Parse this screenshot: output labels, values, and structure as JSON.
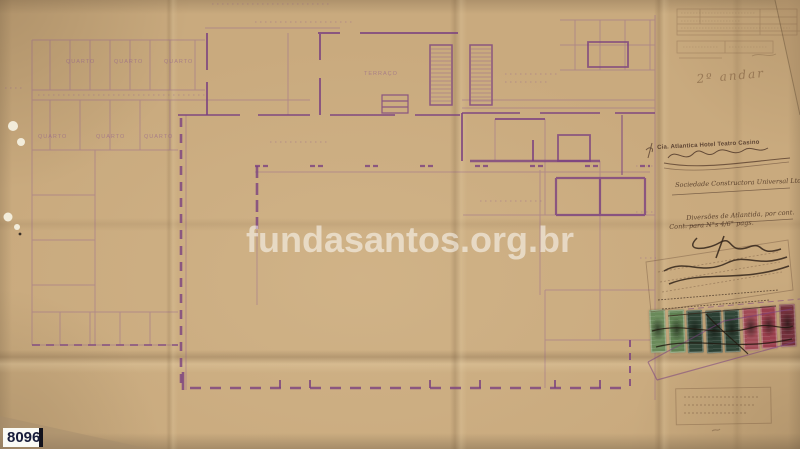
{
  "document": {
    "watermark": "fundasantos.org.br",
    "archive_number": "8096"
  },
  "margin": {
    "floor_note": "2º andar",
    "company_stamp_line": "Cia. Atlantica Hotel Teatro Casino",
    "handwritten_note_1": "Sociedade Constructora Universal Ltda",
    "handwritten_note_2": "Diversões de Atlantida, por cont.",
    "handwritten_note_3": "Cont. para N°s 4/6° pags."
  },
  "plan": {
    "labels": [
      {
        "text": "QUARTO"
      },
      {
        "text": "QUARTO"
      },
      {
        "text": "QUARTO"
      },
      {
        "text": "QUARTO"
      },
      {
        "text": "QUARTO"
      },
      {
        "text": "QUARTO"
      },
      {
        "text": "TERRAÇO"
      }
    ]
  },
  "stamps": {
    "colors": [
      "#6a8a5a",
      "#5f8152",
      "#2f4436",
      "#2b3f33",
      "#2f4436",
      "#a04a55",
      "#9a3f4d",
      "#74313c"
    ]
  },
  "colors": {
    "paper": "#c9aa7e",
    "ink_faint": "#8a5590",
    "ink_dark": "#7a4180",
    "annotation_ink": "#4a3226"
  }
}
